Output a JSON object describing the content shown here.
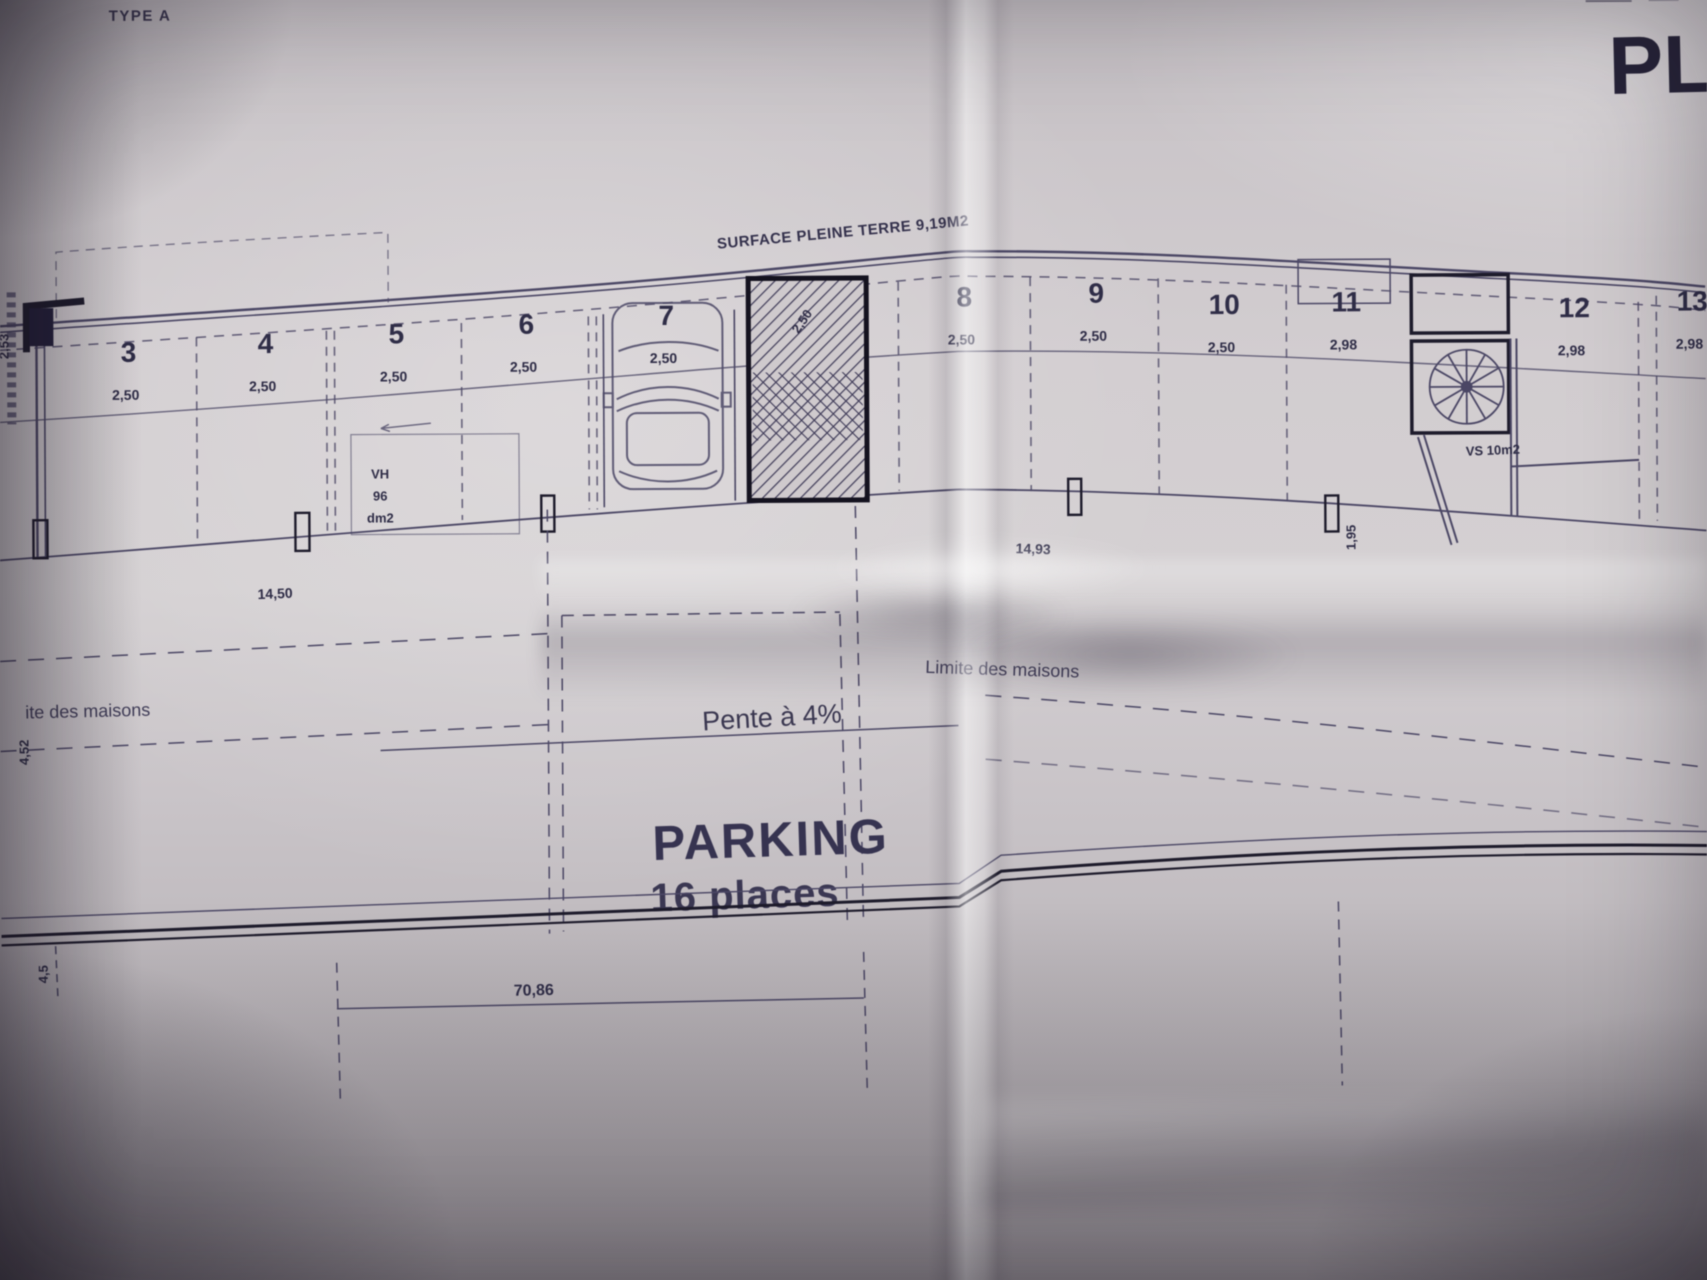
{
  "colors": {
    "paper": "#cbc6c9",
    "ink": "#4b4765",
    "ink_dark": "#1d1b2b"
  },
  "header": {
    "type_label": "TYPE A",
    "plan_title_partial": "PL"
  },
  "plan": {
    "surface_label": "SURFACE PLEINE TERRE 9,19M2",
    "stalls": [
      {
        "num": "3",
        "dim": "2,50",
        "x": 130,
        "y": 358
      },
      {
        "num": "4",
        "dim": "2,50",
        "x": 267,
        "y": 350
      },
      {
        "num": "5",
        "dim": "2,50",
        "x": 398,
        "y": 341
      },
      {
        "num": "6",
        "dim": "2,50",
        "x": 528,
        "y": 332
      },
      {
        "num": "7",
        "dim": "2,50",
        "x": 668,
        "y": 324
      },
      {
        "num": "8",
        "dim": "2,50",
        "x": 966,
        "y": 307
      },
      {
        "num": "9",
        "dim": "2,50",
        "x": 1098,
        "y": 304
      },
      {
        "num": "10",
        "dim": "2,50",
        "x": 1226,
        "y": 316
      },
      {
        "num": "11",
        "dim": "2,98",
        "x": 1348,
        "y": 314
      },
      {
        "num": "12",
        "dim": "2,98",
        "x": 1576,
        "y": 321
      },
      {
        "num": "13",
        "dim": "2,98",
        "x": 1694,
        "y": 315
      }
    ],
    "hatch_dim": "2,50",
    "vh_label_lines": [
      "VH",
      "96",
      "dm2"
    ],
    "vs_label": "VS 10m2",
    "stair_dim_rotated": "1,95",
    "left_dim_rotated": "2,53",
    "left_dim_rotated2": "4,52",
    "bottom_left_dim": "4,5",
    "dim_left": "14,50",
    "dim_right": "14,93",
    "dim_bottom": "70,86",
    "limite_left": "ite des maisons",
    "limite_center": "Limite des maisons",
    "pente_label": "Pente à 4%",
    "parking_title": "PARKING",
    "parking_subtitle": "16 places"
  }
}
